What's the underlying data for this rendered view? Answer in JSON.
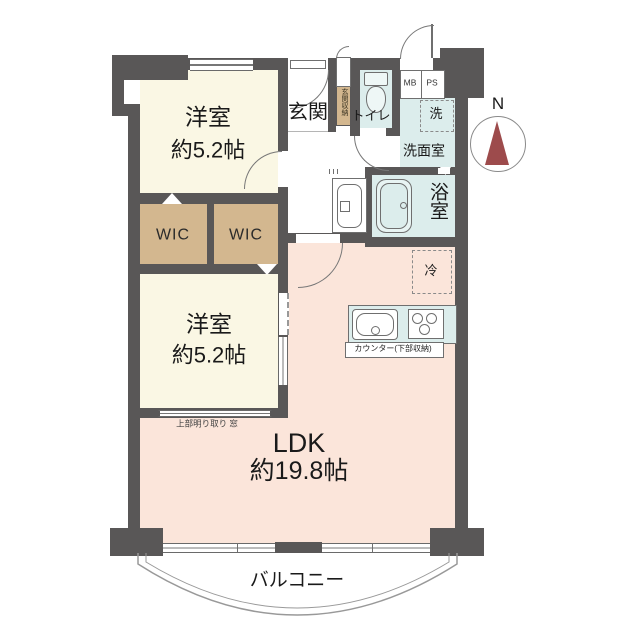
{
  "rooms": {
    "bedroom1": {
      "name": "洋室",
      "size": "約5.2帖"
    },
    "bedroom2": {
      "name": "洋室",
      "size": "約5.2帖"
    },
    "ldk": {
      "name": "LDK",
      "size": "約19.8帖"
    },
    "wic1": {
      "name": "WIC"
    },
    "wic2": {
      "name": "WIC"
    },
    "entrance": {
      "name": "玄関"
    },
    "entrance_storage": {
      "name": "玄関収納"
    },
    "toilet": {
      "name": "トイレ"
    },
    "washroom": {
      "name": "洗面室"
    },
    "washer": {
      "name": "洗"
    },
    "bathroom": {
      "name": "浴室"
    },
    "refrigerator": {
      "name": "冷"
    },
    "meter_box": {
      "name": "MB"
    },
    "pipe_space": {
      "name": "PS"
    },
    "balcony": {
      "name": "バルコニー"
    }
  },
  "annotations": {
    "counter": "カウンター(下部収納)",
    "toplight_window": "上部明り取り 窓",
    "compass_north": "N"
  },
  "colors": {
    "wall": "#595757",
    "room_cream": "#faf7e4",
    "room_pink": "#fbe5da",
    "room_blue": "#dcedec",
    "closet_tan": "#d3b78f",
    "compass_needle": "#9d4b4c"
  }
}
